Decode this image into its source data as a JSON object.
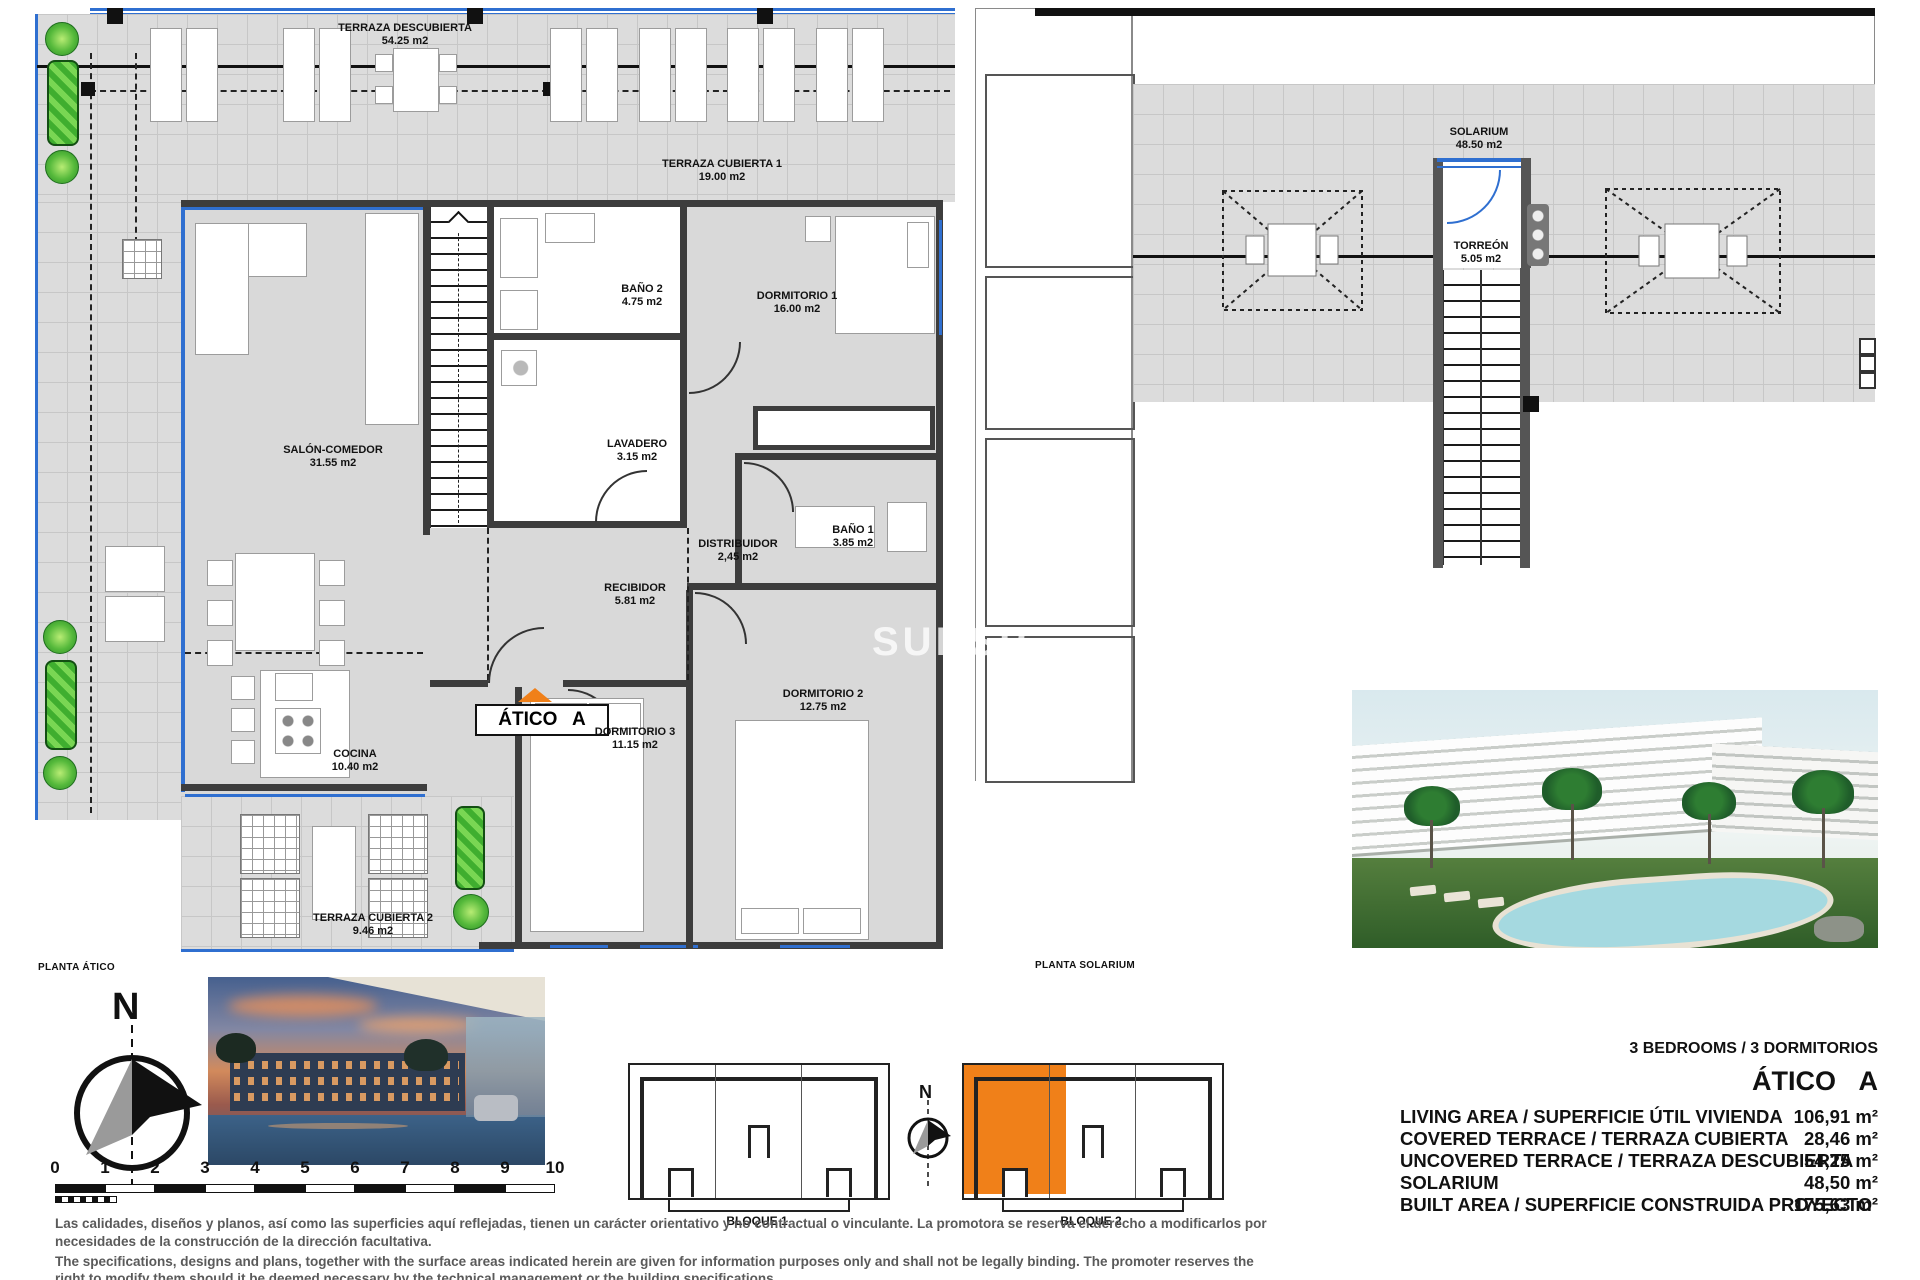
{
  "plan_atico": {
    "title": "PLANTA ÁTICO",
    "unit_badge": "ÁTICO A",
    "rooms": [
      {
        "label": "TERRAZA DESCUBIERTA",
        "area": "54.25 m2"
      },
      {
        "label": "TERRAZA CUBIERTA 1",
        "area": "19.00 m2"
      },
      {
        "label": "SALÓN-COMEDOR",
        "area": "31.55 m2"
      },
      {
        "label": "BAÑO 2",
        "area": "4.75 m2"
      },
      {
        "label": "DORMITORIO 1",
        "area": "16.00 m2"
      },
      {
        "label": "LAVADERO",
        "area": "3.15 m2"
      },
      {
        "label": "DISTRIBUIDOR",
        "area": "2,45 m2"
      },
      {
        "label": "BAÑO 1",
        "area": "3.85 m2"
      },
      {
        "label": "RECIBIDOR",
        "area": "5.81 m2"
      },
      {
        "label": "DORMITORIO 3",
        "area": "11.15 m2"
      },
      {
        "label": "DORMITORIO 2",
        "area": "12.75 m2"
      },
      {
        "label": "COCINA",
        "area": "10.40 m2"
      },
      {
        "label": "TERRAZA CUBIERTA 2",
        "area": "9.46 m2"
      }
    ]
  },
  "plan_solarium": {
    "title": "PLANTA SOLARIUM",
    "rooms": [
      {
        "label": "SOLARIUM",
        "area": "48.50 m2"
      },
      {
        "label": "TORREÓN",
        "area": "5.05 m2"
      }
    ]
  },
  "watermark": "SUNSP",
  "compass": {
    "north": "N"
  },
  "scale_bar": {
    "ticks": [
      "0",
      "1",
      "2",
      "3",
      "4",
      "5",
      "6",
      "7",
      "8",
      "9",
      "10"
    ]
  },
  "key_plans": {
    "bloque1": "BLOQUE 1",
    "bloque2": "BLOQUE 2",
    "north": "N"
  },
  "summary": {
    "bedrooms_line": "3 BEDROOMS / 3 DORMITORIOS",
    "unit_title": "ÁTICO A",
    "rows": [
      {
        "label": "LIVING AREA / SUPERFICIE ÚTIL VIVIENDA",
        "value": "106,91 m²"
      },
      {
        "label": "COVERED TERRACE / TERRAZA CUBIERTA",
        "value": "28,46 m²"
      },
      {
        "label": "UNCOVERED TERRACE / TERRAZA DESCUBIERTA",
        "value": "54,25 m²"
      },
      {
        "label": "SOLARIUM",
        "value": "48,50 m²"
      },
      {
        "label": "BUILT AREA / SUPERFICIE CONSTRUIDA PROYECTO",
        "value": "175,63 m²"
      }
    ]
  },
  "disclaimer": {
    "es_line1": "Las calidades, diseños y planos, así como las superficies aquí reflejadas, tienen un carácter orientativo y no contractual o vinculante. La promotora se reserva el derecho a modificarlos por",
    "es_line2": "necesidades de la construcción de la dirección facultativa.",
    "en_line1": "The specifications, designs and plans, together with the surface areas indicated herein are given for information purposes only and shall not be legally binding. The promoter reserves the",
    "en_line2": "right to modify them should it be deemed necessary by the technical management or the building specifications."
  },
  "colors": {
    "accent_orange": "#f08019",
    "glass_blue": "#2f6fd0",
    "plant_green": "#44b530",
    "terrace_gray": "#dcdcdc",
    "wall_dark": "#3d3d3d"
  }
}
